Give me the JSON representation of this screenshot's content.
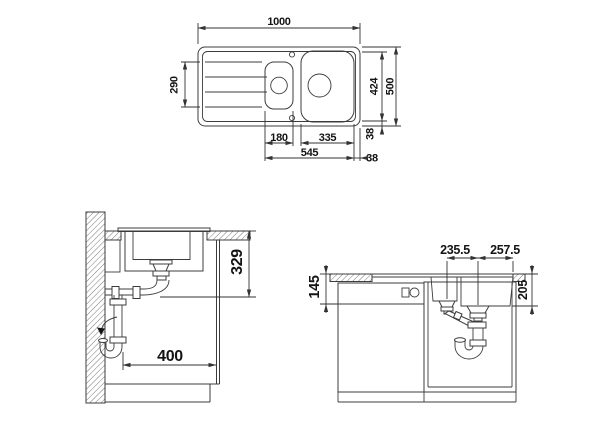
{
  "drawing": {
    "type": "sink installation dimensional drawing",
    "units": "mm",
    "colors": {
      "line": "#3c3c3c",
      "dimension_text": "#141414",
      "background": "#ffffff"
    },
    "views": {
      "top": {
        "name": "plan view of sink",
        "dims": {
          "overall_width": "1000",
          "overall_depth": "500",
          "inner_depth": "424",
          "drainboard_length": "290",
          "small_bowl_width": "180",
          "main_bowl_width": "335",
          "bowls_total_width": "545",
          "rim_gap_vertical": "38",
          "rim_gap_horizontal": "38"
        }
      },
      "side": {
        "name": "side section with drain",
        "dims": {
          "clearance_depth": "329",
          "min_cabinet_width": "400"
        }
      },
      "front": {
        "name": "front section with cabinet",
        "dims": {
          "drain_spacing": "235.5",
          "drain_to_edge": "257.5",
          "appliance_top_height": "145",
          "bowl_depth": "205"
        }
      }
    }
  }
}
